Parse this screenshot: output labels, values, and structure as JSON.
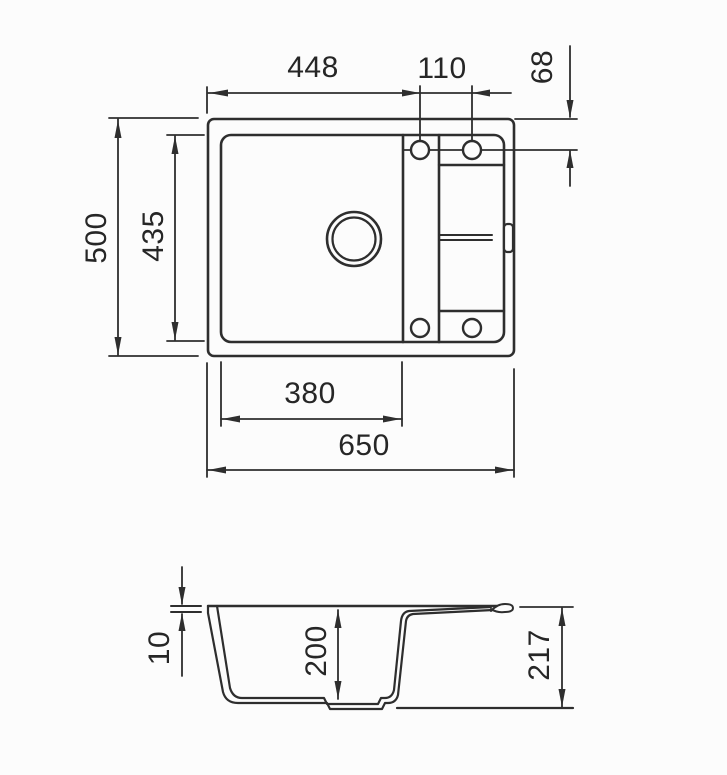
{
  "drawing": {
    "type": "technical-dimension-drawing",
    "subject": "kitchen sink with single bowl and drainer",
    "views": [
      "top view (plan)",
      "side cross-section"
    ]
  },
  "labels": {
    "d448": "448",
    "d110": "110",
    "d68": "68",
    "d500": "500",
    "d435": "435",
    "d380": "380",
    "d650": "650",
    "d10": "10",
    "d200": "200",
    "d217": "217"
  },
  "dimensions_mm": {
    "top_view": {
      "overall_width": 650,
      "overall_depth": 500,
      "bowl_width": 380,
      "bowl_depth": 435,
      "left_edge_to_tap_hole": 448,
      "tap_hole_spacing": 110,
      "top_edge_to_tap_hole": 68
    },
    "section_view": {
      "rim_thickness": 10,
      "bowl_inner_depth": 200,
      "overall_height": 217
    }
  },
  "style": {
    "line_color": "#2e2e2e",
    "background": "#fcfcfc"
  }
}
